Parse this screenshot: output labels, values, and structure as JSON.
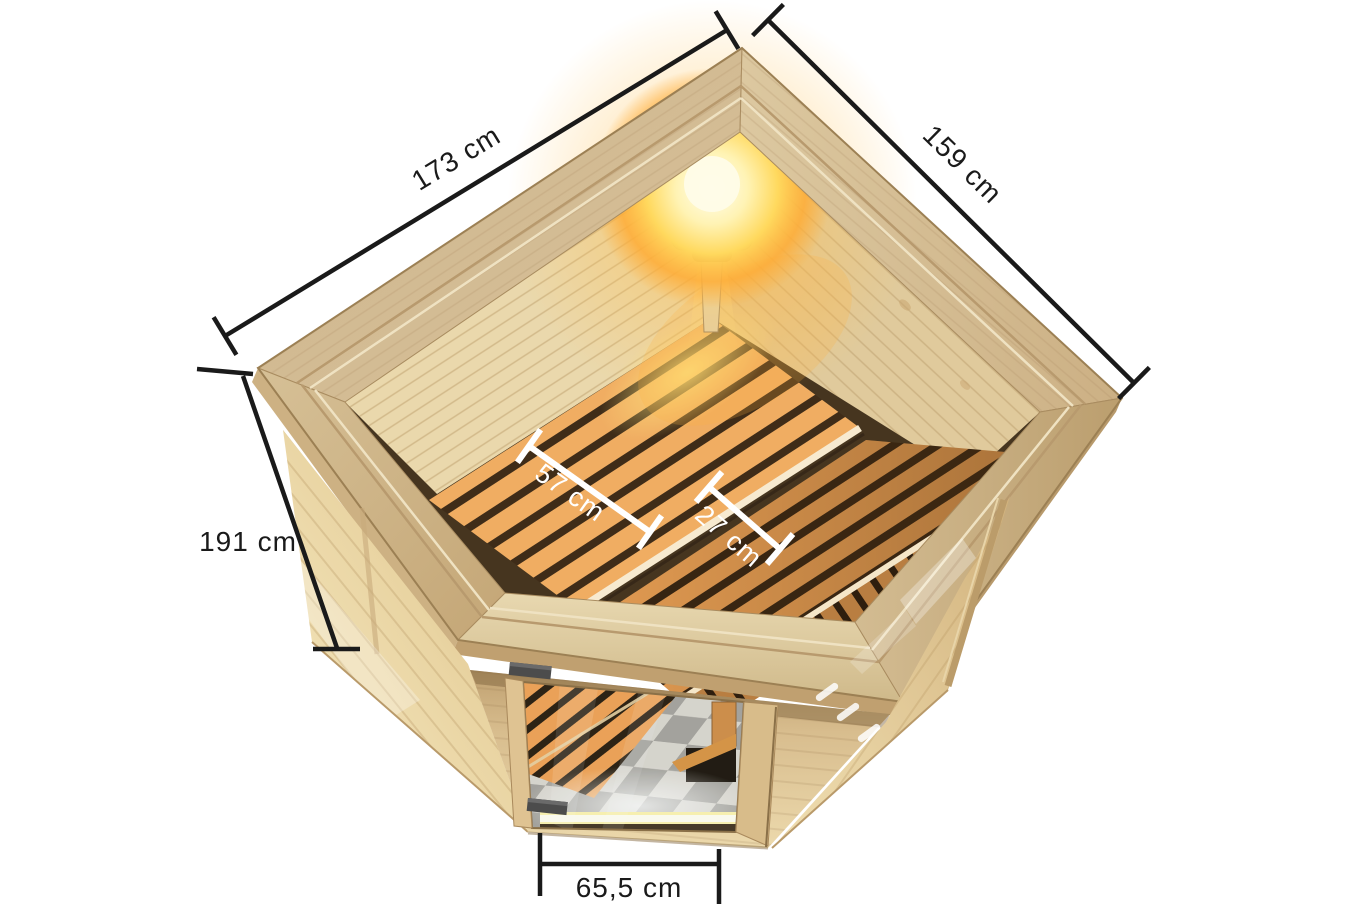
{
  "page": {
    "background": "#ffffff",
    "description": "Top-view 3D product illustration of a wooden corner sauna with interior benches, corner lamp, glass door and dimension annotations"
  },
  "measurements": {
    "back_left_wall": {
      "label": "173 cm"
    },
    "back_right_wall": {
      "label": "159 cm"
    },
    "height": {
      "label": "191 cm"
    },
    "main_bench_depth": {
      "label": "57 cm"
    },
    "second_bench_depth": {
      "label": "27 cm"
    },
    "door_width": {
      "label": "65,5 cm"
    }
  },
  "colors": {
    "dimension_line": "#1a1a1a",
    "dimension_line_interior": "#ffffff",
    "wood_light": "#f2e3ba",
    "wood_mid": "#d9bd8c",
    "wood_molding": "#cdb48a",
    "bench_slat": "#eda95e",
    "slat_gap": "#3d2b18",
    "lamp_glow": "#ffd95e",
    "floor_tile_dark": "#a19d96",
    "floor_tile_light": "#dad6ce"
  }
}
